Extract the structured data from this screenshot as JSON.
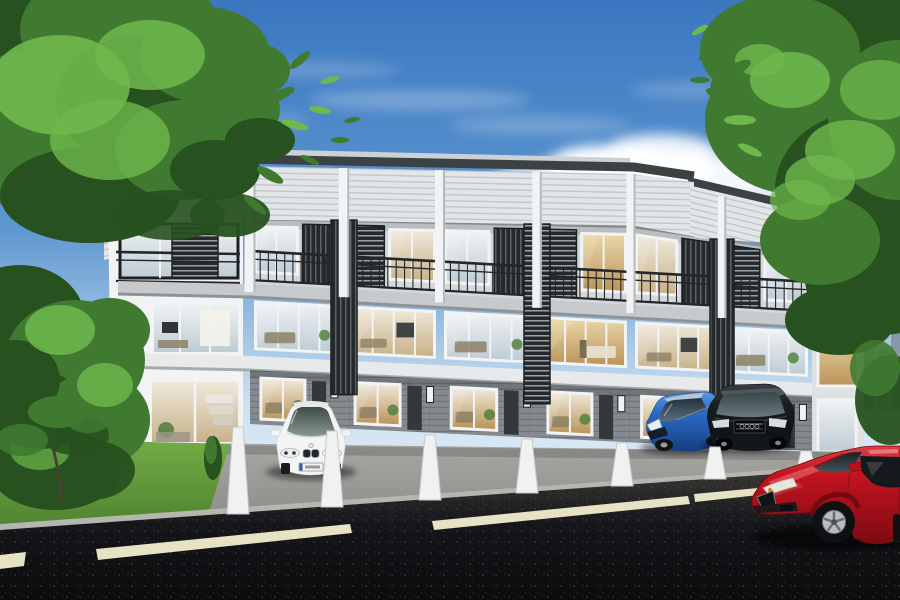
{
  "scene": {
    "type": "architectural-exterior-rendering",
    "description": "Daytime 3D rendering of a modern three-storey townhouse row with six street-facing units, glass facades with dark louver screens and balconies, private driveways separated by white walls, four parked cars (white sedan, blue hatchback, black SUV, red coupe), an asphalt road with dashed lane markings in the foreground, and leafy trees framing both sides under a blue sky with clouds.",
    "time_of_day": "day",
    "sky": {
      "top": "#3a77c0",
      "mid": "#5e97d0",
      "horizon": "#cfe2f2",
      "haze": "#e8f2f9",
      "cloud": "#ffffff"
    },
    "foliage": {
      "deep": "#27511f",
      "mid": "#3f7a30",
      "light": "#6fb84c",
      "accent": "#8ccf63",
      "trunk": "#4a4136"
    },
    "building": {
      "floors": 3,
      "visible_units": 6,
      "roof": "#3c4143",
      "roofLedge": "#ccd1d4",
      "fascia": "#e2e6e8",
      "fasciaLine": "#c2c7ca",
      "wall": "#d4d8da",
      "fin": "#f1f3f4",
      "finShade": "#b4b9bc",
      "panelFrame": "#1d2022",
      "slatDark": "#26292c",
      "slatLight": "#5d6468",
      "railing": "#24272a",
      "slab": "#c6cacc",
      "slabShadow": "#8e9396",
      "slabLower": "#e7e9ea",
      "slabLowerShadow": "#a6abad",
      "brick": "#848a8e",
      "brickLine": "#6e7478",
      "door": "#33383b",
      "divider": "#f0f1f1",
      "dividerShade": "#c6c9ca"
    },
    "interior": {
      "warm": "#efe8da",
      "warmDeep": "#c8b28a",
      "cool": "#eef2f4",
      "coolDeep": "#bfccd4",
      "lit": "#e9d6a8",
      "litDeep": "#bb9458",
      "furniture": "#8d8066",
      "screen": "#2f3437",
      "plant": "#4e7d3a"
    },
    "ground": {
      "lawn": "#74ad45",
      "lawnDark": "#4c8030",
      "driveway": "#a8a7a3",
      "drivewayDark": "#8d8c88",
      "kerb": "#b6b6b0",
      "road": "#3c3b37",
      "roadMid": "#15151a",
      "roadDeep": "#0c0c0e",
      "marking": "#e6e2c4"
    },
    "distant_city": {
      "tower": "#8699ab",
      "towerLight": "#9fb0bd"
    },
    "road_markings": {
      "dash_count": 4
    },
    "cars": [
      {
        "name": "white-sedan",
        "position": "driveway-1",
        "color": "#f3f5f5",
        "glass": "#46544d",
        "detail": "#23272a"
      },
      {
        "name": "blue-hatchback",
        "position": "driveway-5",
        "color": "#2a6cc8",
        "glass": "#1d2a36",
        "detail": "#b9c9da"
      },
      {
        "name": "black-suv",
        "position": "driveway-6",
        "color": "#1b1e21",
        "glass": "#3c4650",
        "detail": "#565e63"
      },
      {
        "name": "red-coupe",
        "position": "road-foreground",
        "color": "#c2141f",
        "glass": "#20282c",
        "detail": "#b9bdbf"
      }
    ]
  }
}
